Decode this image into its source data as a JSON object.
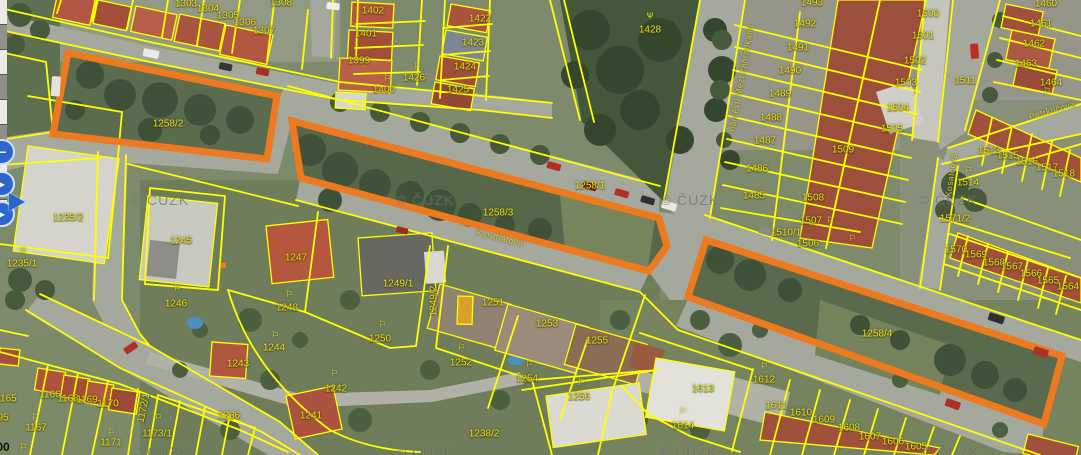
{
  "map": {
    "type": "cadastral-aerial-view",
    "copyright": "© ČÚZK",
    "colors": {
      "parcel_line": "#ffff00",
      "highlight_outline": "#ed7a1f",
      "parcel_label": "#e9e01f",
      "street_label": "#d6cd3a",
      "watermark": "rgba(72,74,66,0.55)"
    },
    "highlighted_parcels": [
      {
        "id": "1258/2",
        "points": "68,53 277,96 267,159 53,134"
      },
      {
        "id": "1258/3",
        "points": "292,121 659,218 667,246 649,271 301,178"
      },
      {
        "id": "1258/4",
        "points": "706,240 1062,356 1044,424 688,297"
      }
    ],
    "highlight_marks": [
      {
        "id": "vertex-dot",
        "x": 221,
        "y": 263,
        "w": 5,
        "h": 5
      }
    ],
    "parcel_labels": [
      {
        "n": "1303",
        "x": 186,
        "y": 4
      },
      {
        "n": "1304",
        "x": 208,
        "y": 9
      },
      {
        "n": "1305",
        "x": 228,
        "y": 16
      },
      {
        "n": "1306",
        "x": 245,
        "y": 23
      },
      {
        "n": "1307",
        "x": 264,
        "y": 31
      },
      {
        "n": "1308",
        "x": 281,
        "y": 3
      },
      {
        "n": "1402",
        "x": 373,
        "y": 11
      },
      {
        "n": "1401",
        "x": 366,
        "y": 34
      },
      {
        "n": "1399",
        "x": 359,
        "y": 61
      },
      {
        "n": "1400",
        "x": 384,
        "y": 90
      },
      {
        "n": "1426",
        "x": 414,
        "y": 78
      },
      {
        "n": "1422",
        "x": 480,
        "y": 19
      },
      {
        "n": "1423",
        "x": 473,
        "y": 43
      },
      {
        "n": "1424",
        "x": 465,
        "y": 67
      },
      {
        "n": "1425",
        "x": 458,
        "y": 90
      },
      {
        "n": "1428",
        "x": 650,
        "y": 30
      },
      {
        "n": "1493",
        "x": 812,
        "y": 3
      },
      {
        "n": "1492",
        "x": 805,
        "y": 24
      },
      {
        "n": "1491",
        "x": 798,
        "y": 48
      },
      {
        "n": "1490",
        "x": 790,
        "y": 71
      },
      {
        "n": "1489",
        "x": 780,
        "y": 94
      },
      {
        "n": "1488",
        "x": 771,
        "y": 118
      },
      {
        "n": "1487",
        "x": 765,
        "y": 141
      },
      {
        "n": "1486",
        "x": 757,
        "y": 169
      },
      {
        "n": "1485",
        "x": 754,
        "y": 196
      },
      {
        "n": "1509",
        "x": 843,
        "y": 150
      },
      {
        "n": "1508",
        "x": 813,
        "y": 198
      },
      {
        "n": "1507",
        "x": 811,
        "y": 221
      },
      {
        "n": "1510/1",
        "x": 786,
        "y": 233
      },
      {
        "n": "1506",
        "x": 808,
        "y": 244
      },
      {
        "n": "1500",
        "x": 928,
        "y": 14
      },
      {
        "n": "1501",
        "x": 923,
        "y": 36
      },
      {
        "n": "1502",
        "x": 915,
        "y": 61
      },
      {
        "n": "1503",
        "x": 906,
        "y": 83
      },
      {
        "n": "1504",
        "x": 898,
        "y": 108
      },
      {
        "n": "1505",
        "x": 892,
        "y": 129
      },
      {
        "n": "1511",
        "x": 965,
        "y": 81
      },
      {
        "n": "1460",
        "x": 1046,
        "y": 4
      },
      {
        "n": "1461",
        "x": 1041,
        "y": 24
      },
      {
        "n": "1462",
        "x": 1034,
        "y": 44
      },
      {
        "n": "1463",
        "x": 1026,
        "y": 64
      },
      {
        "n": "1464",
        "x": 1051,
        "y": 83
      },
      {
        "n": "1513",
        "x": 989,
        "y": 151
      },
      {
        "n": "1515",
        "x": 1008,
        "y": 156
      },
      {
        "n": "1516",
        "x": 1027,
        "y": 162
      },
      {
        "n": "1517",
        "x": 1047,
        "y": 168
      },
      {
        "n": "1518",
        "x": 1064,
        "y": 174
      },
      {
        "n": "1514",
        "x": 968,
        "y": 183
      },
      {
        "n": "1571/2",
        "x": 955,
        "y": 219
      },
      {
        "n": "1570",
        "x": 956,
        "y": 250
      },
      {
        "n": "1569",
        "x": 976,
        "y": 255
      },
      {
        "n": "1568",
        "x": 994,
        "y": 263
      },
      {
        "n": "1567",
        "x": 1012,
        "y": 267
      },
      {
        "n": "1566",
        "x": 1031,
        "y": 274
      },
      {
        "n": "1565",
        "x": 1048,
        "y": 281
      },
      {
        "n": "1564",
        "x": 1068,
        "y": 287
      },
      {
        "n": "1258/2",
        "x": 168,
        "y": 124
      },
      {
        "n": "1258/1",
        "x": 590,
        "y": 186
      },
      {
        "n": "1258/3",
        "x": 498,
        "y": 213
      },
      {
        "n": "1258/4",
        "x": 877,
        "y": 334
      },
      {
        "n": "1235/2",
        "x": 68,
        "y": 218
      },
      {
        "n": "1235/1",
        "x": 22,
        "y": 264
      },
      {
        "n": "1245",
        "x": 181,
        "y": 241
      },
      {
        "n": "1246",
        "x": 176,
        "y": 304
      },
      {
        "n": "1247",
        "x": 296,
        "y": 258
      },
      {
        "n": "1248",
        "x": 287,
        "y": 308
      },
      {
        "n": "1249/1",
        "x": 398,
        "y": 284
      },
      {
        "n": "1249/2",
        "x": 434,
        "y": 301,
        "rot": -90
      },
      {
        "n": "1250",
        "x": 380,
        "y": 339
      },
      {
        "n": "1244",
        "x": 274,
        "y": 348
      },
      {
        "n": "1243",
        "x": 238,
        "y": 364
      },
      {
        "n": "1242",
        "x": 336,
        "y": 389
      },
      {
        "n": "1241",
        "x": 311,
        "y": 416
      },
      {
        "n": "1251",
        "x": 493,
        "y": 303
      },
      {
        "n": "1253",
        "x": 547,
        "y": 324
      },
      {
        "n": "1255",
        "x": 597,
        "y": 341
      },
      {
        "n": "1252",
        "x": 461,
        "y": 363
      },
      {
        "n": "1254",
        "x": 527,
        "y": 379
      },
      {
        "n": "1256",
        "x": 579,
        "y": 397
      },
      {
        "n": "1238/2",
        "x": 484,
        "y": 434
      },
      {
        "n": "1165",
        "x": 6,
        "y": 399
      },
      {
        "n": "1166",
        "x": 50,
        "y": 395
      },
      {
        "n": "1168",
        "x": 68,
        "y": 399
      },
      {
        "n": "1169",
        "x": 87,
        "y": 400
      },
      {
        "n": "1170",
        "x": 108,
        "y": 404
      },
      {
        "n": "1167",
        "x": 36,
        "y": 428
      },
      {
        "n": "1171",
        "x": 111,
        "y": 443
      },
      {
        "n": "1172/1",
        "x": 144,
        "y": 408,
        "rot": -78
      },
      {
        "n": "1173/1",
        "x": 157,
        "y": 434
      },
      {
        "n": "1236",
        "x": 229,
        "y": 416
      },
      {
        "n": "95",
        "x": 3,
        "y": 418
      },
      {
        "n": "1614",
        "x": 683,
        "y": 426
      },
      {
        "n": "1613",
        "x": 703,
        "y": 389
      },
      {
        "n": "1612",
        "x": 764,
        "y": 380
      },
      {
        "n": "1611",
        "x": 776,
        "y": 406
      },
      {
        "n": "1610",
        "x": 801,
        "y": 413
      },
      {
        "n": "1609",
        "x": 824,
        "y": 420
      },
      {
        "n": "1608",
        "x": 849,
        "y": 428
      },
      {
        "n": "1607",
        "x": 870,
        "y": 437
      },
      {
        "n": "1606",
        "x": 893,
        "y": 442
      },
      {
        "n": "1605",
        "x": 916,
        "y": 447
      }
    ],
    "street_labels": [
      {
        "name": "Karafiátová",
        "x": 500,
        "y": 238,
        "rot": 14
      },
      {
        "name": "náměstí Mezi zahrádkami",
        "x": 741,
        "y": 78,
        "rot": -80
      },
      {
        "name": "Petrklíčova",
        "x": 1052,
        "y": 110,
        "rot": -16
      },
      {
        "name": "Kosatcová",
        "x": 951,
        "y": 175,
        "rot": -82
      }
    ],
    "watermarks": [
      {
        "x": 160,
        "y": 200
      },
      {
        "x": 425,
        "y": 200
      },
      {
        "x": 690,
        "y": 200
      },
      {
        "x": 948,
        "y": 200
      },
      {
        "x": 160,
        "y": 452
      },
      {
        "x": 425,
        "y": 452
      },
      {
        "x": 688,
        "y": 452
      },
      {
        "x": 950,
        "y": 452
      }
    ],
    "symbol_glyphs": {
      "tree": "Ψ",
      "garden": "⚐"
    },
    "symbols": [
      {
        "t": "tree",
        "x": 650,
        "y": 16
      },
      {
        "t": "tree",
        "x": 23,
        "y": 251
      },
      {
        "t": "garden",
        "x": 417,
        "y": 67
      },
      {
        "t": "garden",
        "x": 387,
        "y": 79
      },
      {
        "t": "garden",
        "x": 830,
        "y": 221
      },
      {
        "t": "garden",
        "x": 852,
        "y": 239
      },
      {
        "t": "garden",
        "x": 968,
        "y": 171
      },
      {
        "t": "garden",
        "x": 1047,
        "y": 92
      },
      {
        "t": "garden",
        "x": 289,
        "y": 295
      },
      {
        "t": "garden",
        "x": 275,
        "y": 336
      },
      {
        "t": "garden",
        "x": 334,
        "y": 374
      },
      {
        "t": "garden",
        "x": 382,
        "y": 325
      },
      {
        "t": "garden",
        "x": 461,
        "y": 348
      },
      {
        "t": "garden",
        "x": 529,
        "y": 365
      },
      {
        "t": "garden",
        "x": 581,
        "y": 383
      },
      {
        "t": "garden",
        "x": 177,
        "y": 289
      },
      {
        "t": "garden",
        "x": 35,
        "y": 418
      },
      {
        "t": "garden",
        "x": 111,
        "y": 433
      },
      {
        "t": "garden",
        "x": 158,
        "y": 418
      },
      {
        "t": "garden",
        "x": 23,
        "y": 448
      },
      {
        "t": "garden",
        "x": 683,
        "y": 412
      },
      {
        "t": "garden",
        "x": 764,
        "y": 367
      }
    ],
    "misc_labels": [
      {
        "text": "00",
        "x": 3,
        "y": 447,
        "color": "#111111",
        "size": 12,
        "bold": true
      }
    ],
    "vehicles": [
      {
        "x": 144,
        "y": 48,
        "w": 16,
        "h": 8,
        "rot": 12,
        "c": "#eceae6"
      },
      {
        "x": 52,
        "y": 76,
        "w": 9,
        "h": 20,
        "rot": 4,
        "c": "#e4e4de"
      },
      {
        "x": 327,
        "y": 2,
        "w": 13,
        "h": 7,
        "rot": 6,
        "c": "#f0efeb"
      },
      {
        "x": 220,
        "y": 62,
        "w": 13,
        "h": 7,
        "rot": 12,
        "c": "#34343a"
      },
      {
        "x": 257,
        "y": 67,
        "w": 13,
        "h": 7,
        "rot": 12,
        "c": "#aa2d24"
      },
      {
        "x": 548,
        "y": 161,
        "w": 14,
        "h": 7,
        "rot": 15,
        "c": "#b03028"
      },
      {
        "x": 584,
        "y": 181,
        "w": 14,
        "h": 7,
        "rot": 16,
        "c": "#7c1f1a"
      },
      {
        "x": 616,
        "y": 188,
        "w": 14,
        "h": 7,
        "rot": 16,
        "c": "#b03028"
      },
      {
        "x": 642,
        "y": 195,
        "w": 14,
        "h": 7,
        "rot": 16,
        "c": "#303036"
      },
      {
        "x": 663,
        "y": 200,
        "w": 15,
        "h": 8,
        "rot": 16,
        "c": "#e8e8e2"
      },
      {
        "x": 760,
        "y": 226,
        "w": 13,
        "h": 7,
        "rot": 16,
        "c": "#8a8a86"
      },
      {
        "x": 970,
        "y": 44,
        "w": 8,
        "h": 15,
        "rot": -4,
        "c": "#c02b22"
      },
      {
        "x": 990,
        "y": 312,
        "w": 16,
        "h": 8,
        "rot": 18,
        "c": "#2e2e34"
      },
      {
        "x": 1035,
        "y": 346,
        "w": 15,
        "h": 8,
        "rot": 18,
        "c": "#b03028"
      },
      {
        "x": 947,
        "y": 398,
        "w": 15,
        "h": 8,
        "rot": 19,
        "c": "#b03028"
      },
      {
        "x": 123,
        "y": 349,
        "w": 14,
        "h": 7,
        "rot": -35,
        "c": "#b03028"
      },
      {
        "x": 397,
        "y": 226,
        "w": 12,
        "h": 6,
        "rot": 14,
        "c": "#a02820"
      }
    ],
    "ui": {
      "pan_buttons": [
        {
          "glyph": "−",
          "x": -11,
          "y": 139
        },
        {
          "glyph": "▸",
          "x": -11,
          "y": 171
        },
        {
          "glyph": "▸",
          "x": -11,
          "y": 201
        }
      ]
    }
  }
}
